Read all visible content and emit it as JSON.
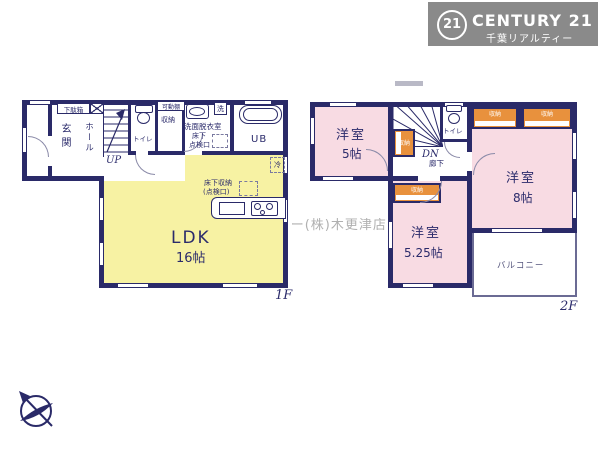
{
  "logo": {
    "badge": "21",
    "brand": "CENTURY 21",
    "subtitle": "千葉リアルティー"
  },
  "watermark": {
    "text": "C21千葉リアルティー(株)木更津店"
  },
  "f1": {
    "label": "1F",
    "genkan": "玄関",
    "hall": "ホール",
    "getabako": "下駄箱",
    "up": "UP",
    "toilet": "トイレ",
    "kadodana": "可動棚",
    "shuno": "収納",
    "senmen": "洗面脱衣室",
    "yukashita1": "床下",
    "yukashita2": "点検口",
    "washer": "洗",
    "ub": "UB",
    "fridge": "冷",
    "fstorage1": "床下収納",
    "fstorage2": "(点検口)",
    "ldk": "LDK",
    "ldk_size": "16帖"
  },
  "f2": {
    "label": "2F",
    "room5": "洋室",
    "room5_size": "5帖",
    "dn": "DN",
    "toilet": "トイレ",
    "hallway": "廊下",
    "shuno": "収納",
    "room8": "洋室",
    "room8_size": "8帖",
    "room525": "洋室",
    "room525_size": "5.25帖",
    "balcony": "バルコニー"
  },
  "colors": {
    "wall": "#2a2a68",
    "ldk_yellow": "#f7f2a3",
    "room_pink": "#f8dbe3",
    "closet_orange": "#e8913d",
    "logo_gray": "#8a8a8a"
  }
}
